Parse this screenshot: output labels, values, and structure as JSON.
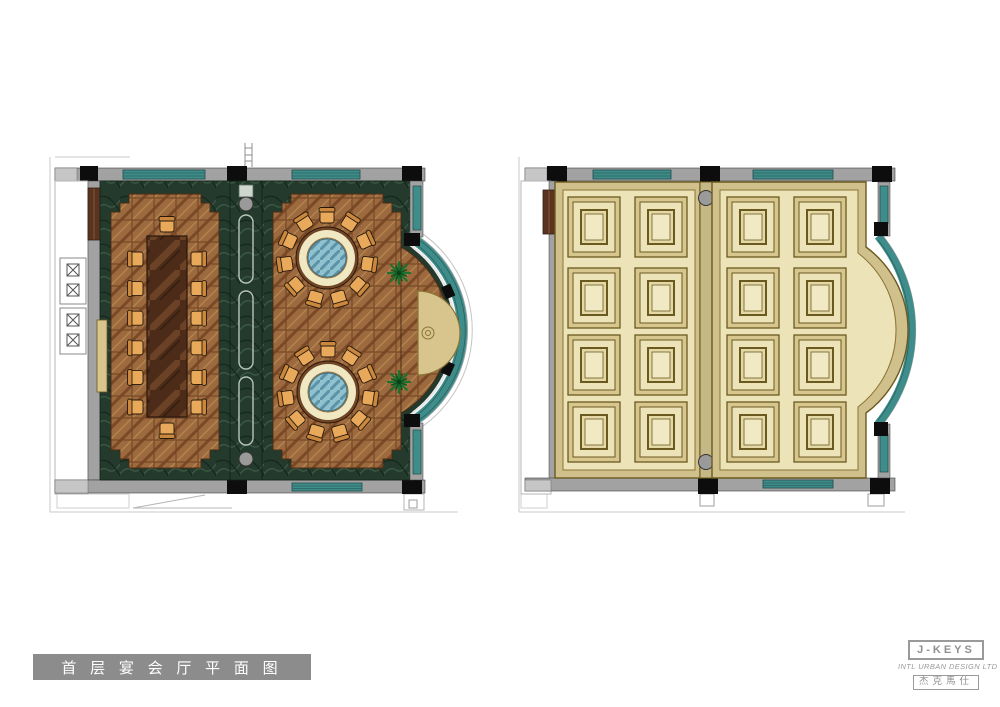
{
  "title_block": {
    "label": "首 层 宴 会 厅 平 面 图"
  },
  "logo": {
    "brand": "J-KEYS",
    "subtitle": "INTL URBAN DESIGN LTD",
    "brand_cn": "杰克馬仕"
  },
  "floor_plan": {
    "conference_table": {
      "side_chairs_per_side": 6,
      "end_chairs": 2
    },
    "round_tables": {
      "count": 2,
      "chairs_each": 11
    },
    "plants": 2
  },
  "ceiling_plan": {
    "rooms": 2,
    "panel_grid": {
      "cols": 2,
      "rows": 4
    }
  },
  "colors": {
    "wall_gray": "#a2a2a2",
    "wall_light": "#c6c6c6",
    "column_black": "#0d0d0d",
    "window_teal": "#3f8d8a",
    "window_teal_dark": "#2a6360",
    "marble_green": "#233a2c",
    "parquet_brown": "#9c6a3e",
    "table_wood": "#4c2c19",
    "chair_seat": "#e9a95b",
    "chair_back": "#c9883d",
    "round_table_ring": "#f0e8c2",
    "round_table_rim": "#6f4526",
    "glass_blue": "#8fc2ce",
    "console_gold": "#d8c58e",
    "plant_green": "#1e7230",
    "ceiling_cream": "#ece3b8",
    "ceiling_tan": "#cfc08c",
    "panel_frame": "#6b5a1f",
    "panel_band": "#d7c78f",
    "title_bar_gray": "#8c8c8c",
    "logo_gray": "#9a9a9a"
  }
}
